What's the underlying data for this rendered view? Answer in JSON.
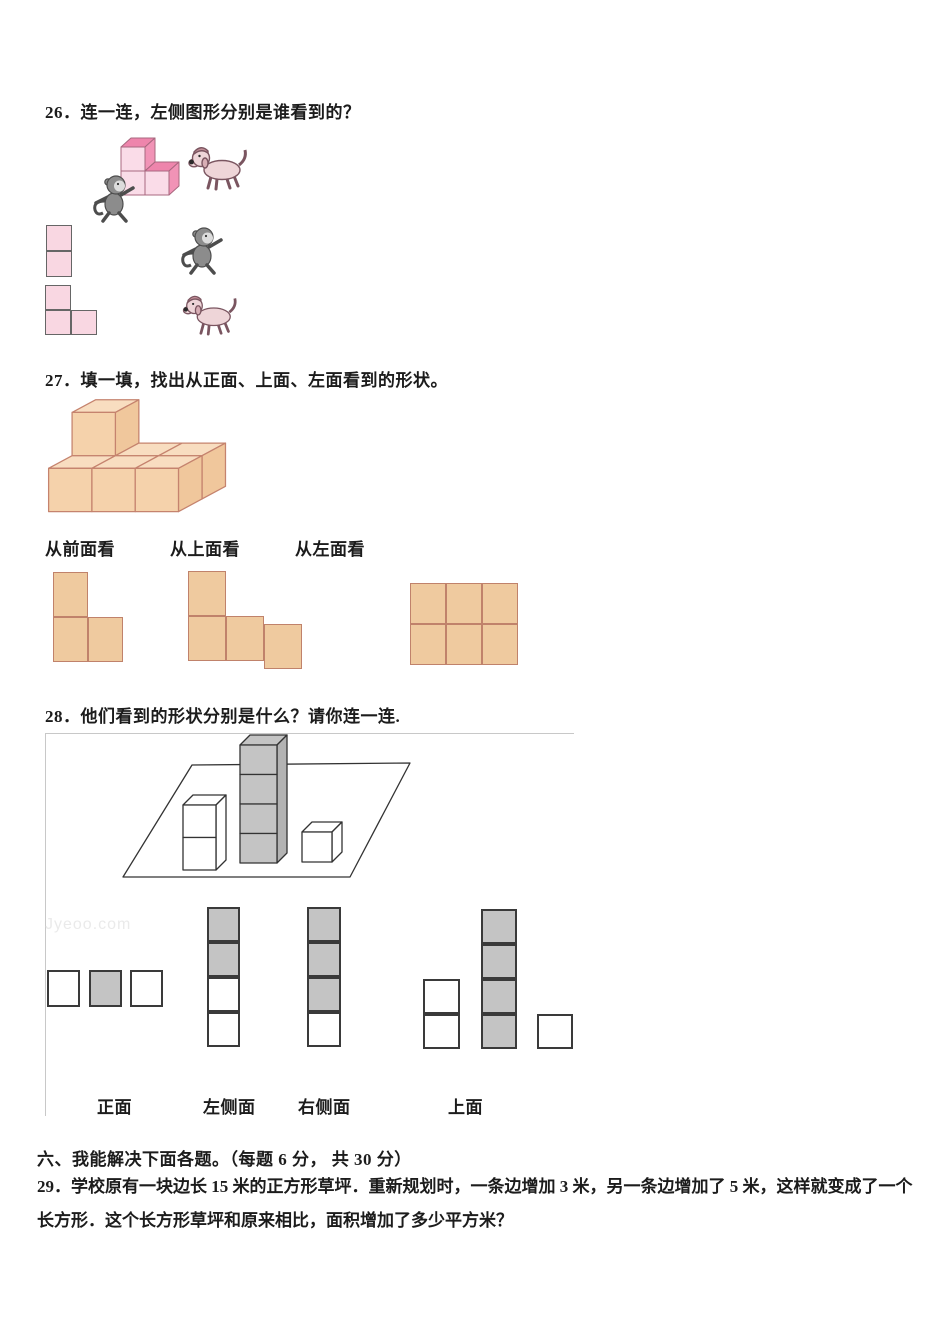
{
  "page": {
    "width": 950,
    "height": 1344,
    "background": "#ffffff"
  },
  "palette": {
    "text": "#1c1c1c",
    "pink_cube_front": "#fadce8",
    "pink_cube_top": "#ee85ac",
    "pink_cube_side": "#f193b6",
    "pink_flat_fill": "#f9d7e2",
    "pink_stroke": "#a8687f",
    "tan_cube_front": "#f5d2ab",
    "tan_cube_top": "#f8ddc0",
    "tan_cube_side": "#f0c79c",
    "tan_stroke": "#c5836e",
    "tan_flat_fill": "#efca9f",
    "tan_flat_stroke": "#c0826b",
    "gray_cube_fill": "#c4c4c4",
    "dark_line": "#3a3a3a",
    "figure_box_border": "#c8c8c8",
    "monkey_gray": "#8c8c8c",
    "dog_pink": "#eed5d8"
  },
  "questions": {
    "q26": {
      "text": "26．连一连，左侧图形分别是谁看到的？"
    },
    "q27": {
      "text": "27．填一填，找出从正面、上面、左面看到的形状。",
      "view_labels": [
        "从前面看",
        "从上面看",
        "从左面看"
      ]
    },
    "q28": {
      "text": "28．他们看到的形状分别是什么？请你连一连.",
      "view_labels": [
        "正面",
        "左侧面",
        "右侧面",
        "上面"
      ]
    },
    "section6": {
      "title": "六、我能解决下面各题。（每题 6 分， 共 30 分）"
    },
    "q29": {
      "line1": "29．学校原有一块边长 15 米的正方形草坪．重新规划时，一条边增加 3 米，另一条边增加了 5 米，这样就变成了一个",
      "line2": "长方形．这个长方形草坪和原来相比，面积增加了多少平方米？"
    }
  },
  "watermark": {
    "text": "Jyeoo.com"
  },
  "figures": {
    "square_shapes": {
      "q26_vertical2": {
        "x": 46,
        "y": 225,
        "w": 26,
        "h": 26,
        "fill": "#f9d7e2",
        "stroke": "#666666",
        "bw": 1,
        "cells": [
          [
            0,
            0
          ],
          [
            0,
            26
          ]
        ]
      },
      "q26_lshape": {
        "x": 45,
        "y": 285,
        "w": 26,
        "h": 25,
        "fill": "#f9d7e2",
        "stroke": "#666666",
        "bw": 1,
        "cells": [
          [
            0,
            0
          ],
          [
            0,
            25
          ],
          [
            26,
            25
          ]
        ]
      },
      "q27_front_view": {
        "x": 53,
        "y": 572,
        "w": 35,
        "h": 45,
        "fill": "#efca9f",
        "stroke": "#c0826b",
        "bw": 1,
        "cells": [
          [
            0,
            0
          ],
          [
            0,
            45
          ],
          [
            35,
            45
          ]
        ]
      },
      "q27_top_view": {
        "x": 188,
        "y": 571,
        "w": 38,
        "h": 45,
        "fill": "#efca9f",
        "stroke": "#c0826b",
        "bw": 1,
        "cells": [
          [
            0,
            0
          ],
          [
            0,
            45
          ],
          [
            38,
            45
          ],
          [
            76,
            53
          ]
        ]
      },
      "q27_left_view": {
        "x": 410,
        "y": 583,
        "w": 36,
        "h": 41,
        "fill": "#efca9f",
        "stroke": "#c0826b",
        "bw": 1,
        "cells": [
          [
            0,
            0
          ],
          [
            36,
            0
          ],
          [
            72,
            0
          ],
          [
            0,
            41
          ],
          [
            36,
            41
          ],
          [
            72,
            41
          ]
        ]
      },
      "q28_front_row": {
        "x": 47,
        "y": 970,
        "w": 33,
        "h": 37,
        "fill": "#ffffff",
        "stroke": "#3a3a3a",
        "bw": 2,
        "cells": [
          [
            0,
            0,
            "#ffffff"
          ],
          [
            42,
            0,
            "#c4c4c4"
          ],
          [
            83,
            0,
            "#ffffff"
          ]
        ]
      },
      "q28_left_col": {
        "x": 207,
        "y": 907,
        "w": 33,
        "h": 35,
        "fill": "#ffffff",
        "stroke": "#3a3a3a",
        "bw": 2,
        "cells": [
          [
            0,
            0,
            "#c4c4c4"
          ],
          [
            0,
            35,
            "#c4c4c4"
          ],
          [
            0,
            70,
            "#ffffff"
          ],
          [
            0,
            105,
            "#ffffff"
          ]
        ]
      },
      "q28_right_col": {
        "x": 307,
        "y": 907,
        "w": 34,
        "h": 35,
        "fill": "#ffffff",
        "stroke": "#3a3a3a",
        "bw": 2,
        "cells": [
          [
            0,
            0,
            "#c4c4c4"
          ],
          [
            0,
            35,
            "#c4c4c4"
          ],
          [
            0,
            70,
            "#c4c4c4"
          ],
          [
            0,
            105,
            "#ffffff"
          ]
        ]
      },
      "q28_top_white2": {
        "x": 423,
        "y": 979,
        "w": 37,
        "h": 35,
        "fill": "#ffffff",
        "stroke": "#3a3a3a",
        "bw": 2,
        "cells": [
          [
            0,
            0
          ],
          [
            0,
            35
          ]
        ]
      },
      "q28_top_gray4": {
        "x": 481,
        "y": 909,
        "w": 36,
        "h": 35,
        "fill": "#c4c4c4",
        "stroke": "#3a3a3a",
        "bw": 2,
        "cells": [
          [
            0,
            0
          ],
          [
            0,
            35
          ],
          [
            0,
            70
          ],
          [
            0,
            105
          ]
        ]
      },
      "q28_top_white1": {
        "x": 537,
        "y": 1014,
        "w": 36,
        "h": 35,
        "fill": "#ffffff",
        "stroke": "#3a3a3a",
        "bw": 2,
        "cells": [
          [
            0,
            0
          ]
        ]
      }
    }
  }
}
